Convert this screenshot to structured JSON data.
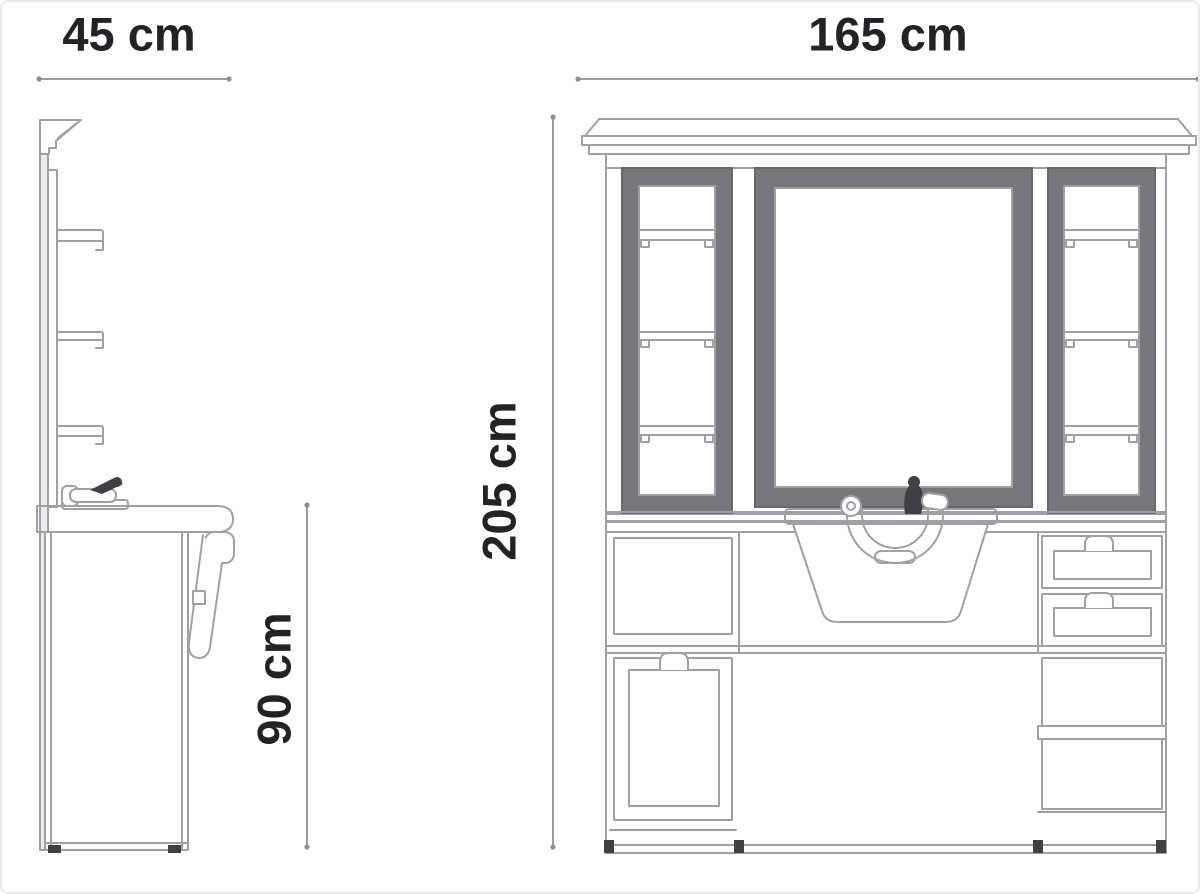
{
  "labels": {
    "side_width": "45 cm",
    "front_width": "165 cm",
    "overall_height": "205 cm",
    "worktop_height": "90 cm"
  },
  "colors": {
    "text": "#232327",
    "dim_line": "#8f8f96",
    "line_light": "#9fa0a6",
    "frame_dark": "#77777e",
    "frame_dark_edge": "#67676e",
    "accent_dark": "#3f3f46",
    "bg": "#ffffff",
    "border": "#e9e9ec"
  }
}
